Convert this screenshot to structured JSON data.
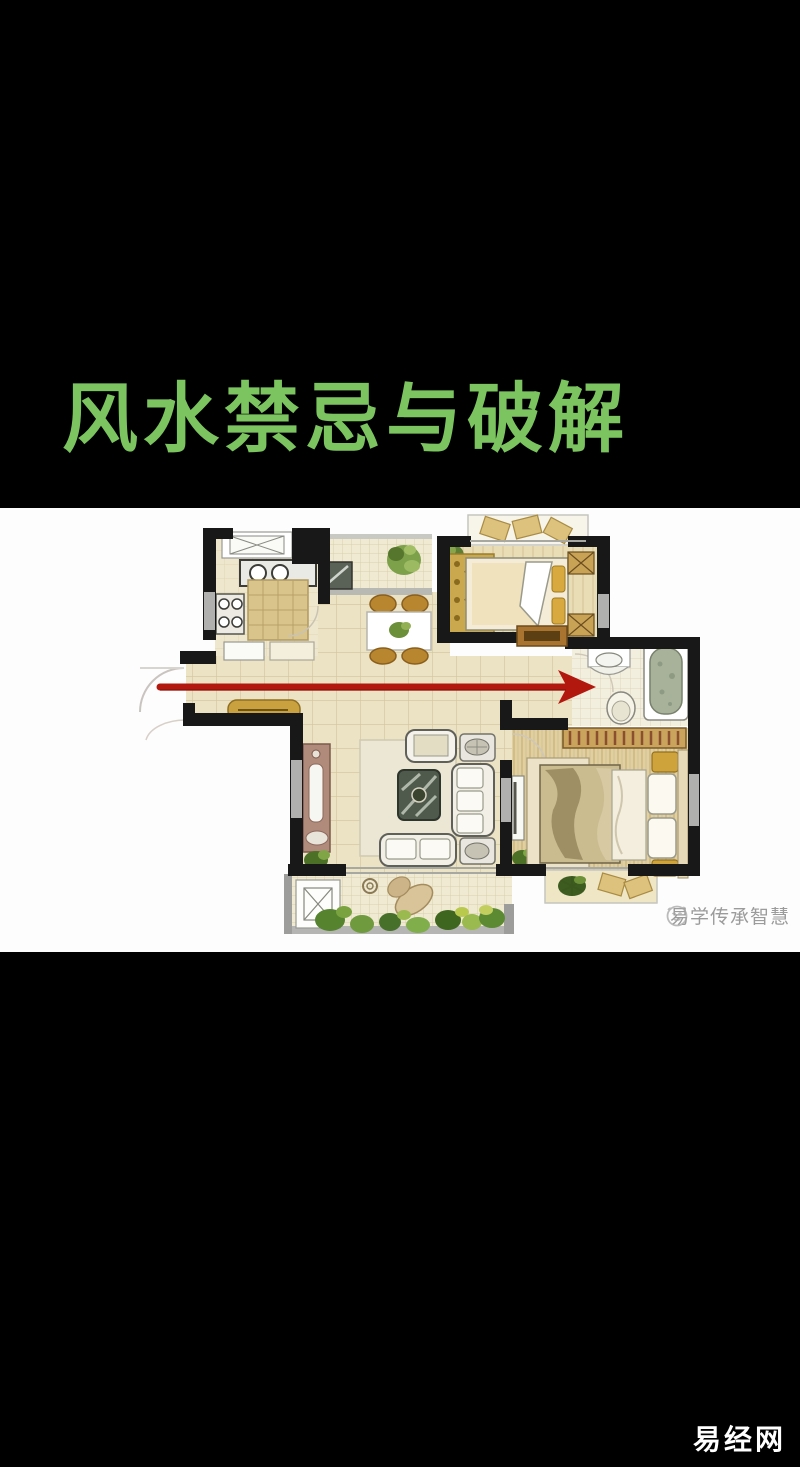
{
  "frame": {
    "background_color": "#000000"
  },
  "title": {
    "text": "风水禁忌与破解",
    "color": "#7cc45f"
  },
  "floorplan": {
    "panel_background": "#fdfdfd",
    "wall_color": "#181818",
    "floor_tile_color": "#ece3c5",
    "arrow_color": "#b2180e",
    "watermark": {
      "icon": "smiley-face-logo",
      "text": "易学传承智慧",
      "color": "#9b9b9b"
    }
  },
  "footer": {
    "brand": "易经网",
    "color": "#ffffff"
  }
}
